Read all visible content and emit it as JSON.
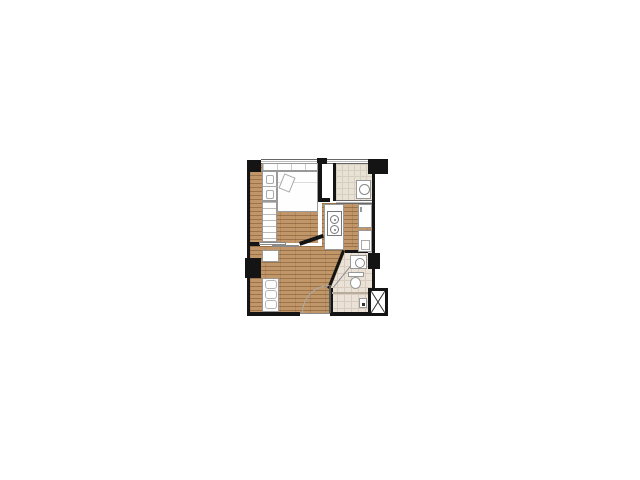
{
  "canvas": {
    "width": 640,
    "height": 480,
    "background_color": "#ffffff"
  },
  "colors": {
    "wall": "#141414",
    "wood_base": "#c1976a",
    "wood_line": "#a3784c",
    "tile_base": "#e8e2d5",
    "tile_line": "#d6cec0",
    "bath_tile_base": "#eae1d7",
    "bath_tile_line": "#d9ccbe",
    "fixture_fill": "#fefefe",
    "fixture_line": "#999999",
    "window_line": "#666666",
    "door_arc": "#aaaaaa",
    "background": "#ffffff"
  },
  "floor_plan": {
    "description": "small one-bedroom condominium unit floor plan, unlabeled, centered on white background",
    "rooms": [
      {
        "id": "bedroom",
        "floor": "wood",
        "fixtures": [
          "double-bed",
          "pillow",
          "headboard-shelf",
          "wardrobe",
          "dresser",
          "sliding-door"
        ]
      },
      {
        "id": "balcony-laundry",
        "floor": "tile",
        "fixtures": [
          "washing-machine",
          "railing",
          "sliding-threshold"
        ]
      },
      {
        "id": "kitchen",
        "floor": "wood",
        "fixtures": [
          "counter",
          "two-burner-stove",
          "refrigerator",
          "lower-cabinet-sink"
        ]
      },
      {
        "id": "living-area",
        "floor": "wood",
        "fixtures": [
          "sofa",
          "console-cabinet",
          "entrance-door-swing"
        ]
      },
      {
        "id": "bathroom",
        "floor": "tile",
        "fixtures": [
          "washbasin",
          "toilet",
          "shower-strip",
          "diagonal-entry-wall",
          "water-heater"
        ]
      },
      {
        "id": "service-shaft",
        "floor": "none",
        "fixtures": [
          "cross-marked-shaft"
        ]
      }
    ],
    "structure": [
      "exterior-walls",
      "concrete-columns",
      "windows"
    ]
  }
}
